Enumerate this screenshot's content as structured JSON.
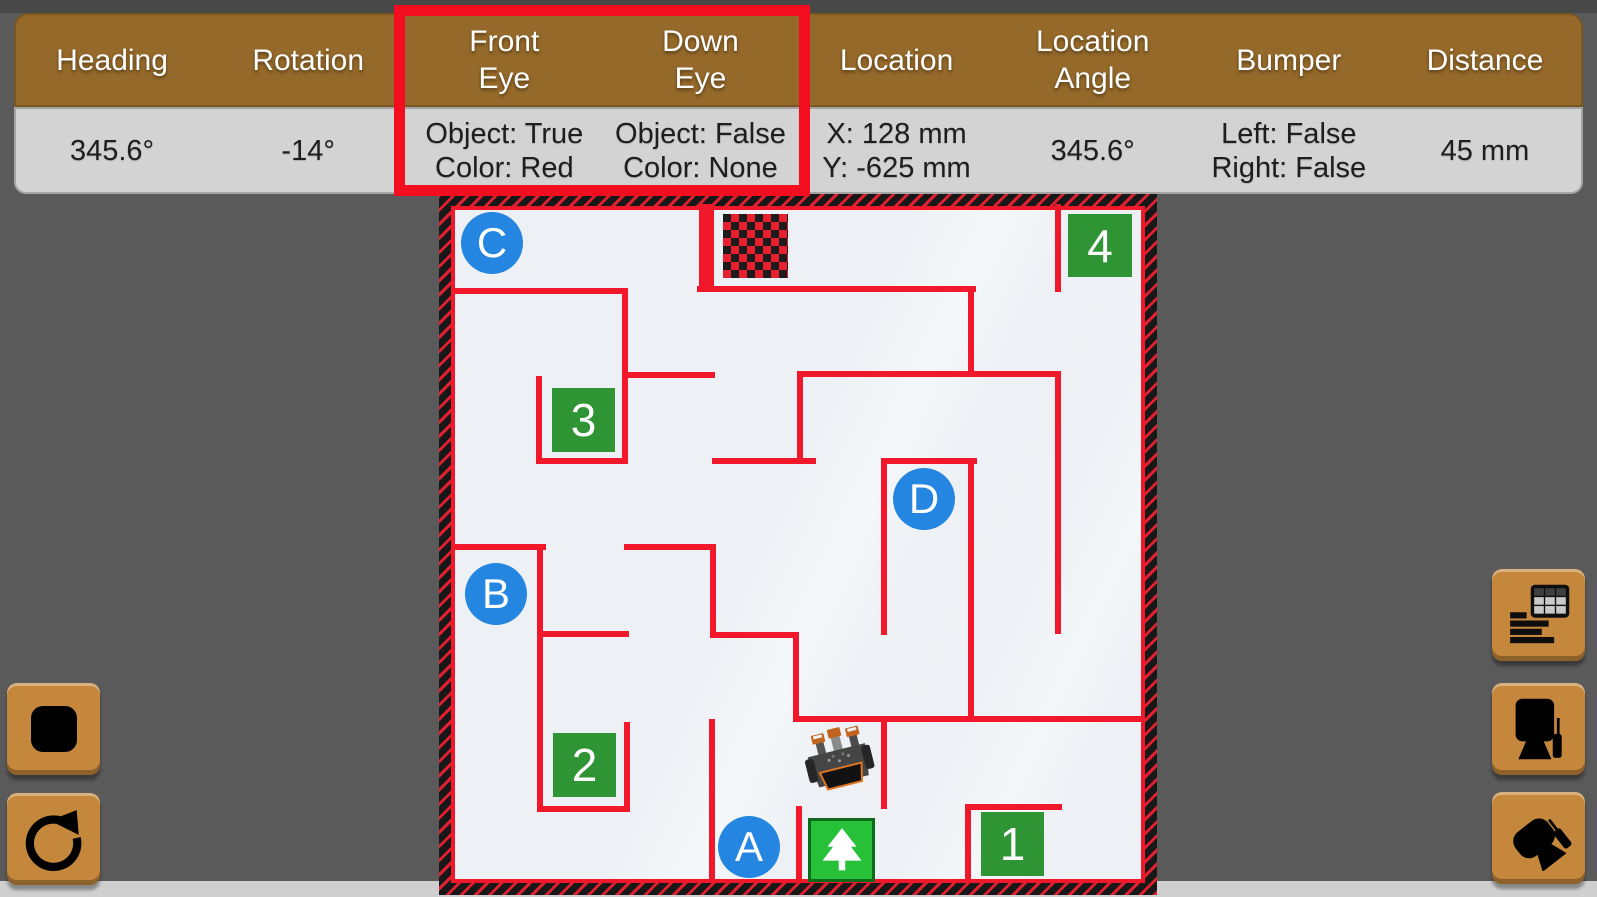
{
  "colors": {
    "page_bg": "#5a5a5a",
    "top_strip": "#484848",
    "bottom_strip": "#cfcfcf",
    "header_bg": "#956929",
    "value_bg": "#d3d3d3",
    "highlight": "#f20d1f",
    "wall": "#f0182a",
    "hazard_red": "#e02030",
    "hazard_black": "#181818",
    "marker_blue": "#2486e0",
    "zone_green": "#2e9434",
    "start_green": "#26c138",
    "check_red": "#e81f2d",
    "check_black": "#1c1c1c",
    "button_orange": "#c5873b"
  },
  "status_bar": {
    "columns": [
      {
        "id": "heading",
        "label_lines": [
          "Heading"
        ],
        "value_lines": [
          "345.6°"
        ]
      },
      {
        "id": "rotation",
        "label_lines": [
          "Rotation"
        ],
        "value_lines": [
          "-14°"
        ]
      },
      {
        "id": "front-eye",
        "label_lines": [
          "Front",
          "Eye"
        ],
        "value_lines": [
          "Object: True",
          "Color: Red"
        ],
        "highlighted": true
      },
      {
        "id": "down-eye",
        "label_lines": [
          "Down",
          "Eye"
        ],
        "value_lines": [
          "Object: False",
          "Color: None"
        ],
        "highlighted": true
      },
      {
        "id": "location",
        "label_lines": [
          "Location"
        ],
        "value_lines": [
          "X: 128 mm",
          "Y: -625 mm"
        ]
      },
      {
        "id": "location-angle",
        "label_lines": [
          "Location",
          "Angle"
        ],
        "value_lines": [
          "345.6°"
        ]
      },
      {
        "id": "bumper",
        "label_lines": [
          "Bumper"
        ],
        "value_lines": [
          "Left: False",
          "Right: False"
        ]
      },
      {
        "id": "distance",
        "label_lines": [
          "Distance"
        ],
        "value_lines": [
          "45 mm"
        ]
      }
    ]
  },
  "maze": {
    "walls": [
      [
        260,
        10,
        15,
        88
      ],
      [
        258,
        92,
        279,
        6
      ],
      [
        529,
        92,
        6,
        91
      ],
      [
        358,
        177,
        264,
        6
      ],
      [
        358,
        177,
        6,
        93
      ],
      [
        273,
        264,
        104,
        6
      ],
      [
        616,
        10,
        6,
        88
      ],
      [
        616,
        177,
        6,
        263
      ],
      [
        12,
        94,
        177,
        6
      ],
      [
        183,
        94,
        6,
        176
      ],
      [
        97,
        182,
        6,
        88
      ],
      [
        97,
        264,
        92,
        6
      ],
      [
        189,
        178,
        87,
        6
      ],
      [
        442,
        264,
        96,
        6
      ],
      [
        442,
        264,
        6,
        177
      ],
      [
        529,
        264,
        6,
        262
      ],
      [
        354,
        522,
        348,
        6
      ],
      [
        354,
        438,
        6,
        90
      ],
      [
        271,
        438,
        89,
        6
      ],
      [
        271,
        350,
        6,
        94
      ],
      [
        185,
        350,
        92,
        6
      ],
      [
        12,
        350,
        95,
        6
      ],
      [
        98,
        350,
        6,
        265
      ],
      [
        98,
        437,
        92,
        6
      ],
      [
        185,
        528,
        6,
        85
      ],
      [
        98,
        612,
        93,
        6
      ],
      [
        270,
        525,
        6,
        160
      ],
      [
        442,
        522,
        6,
        93
      ],
      [
        526,
        610,
        97,
        6
      ],
      [
        526,
        610,
        6,
        75
      ],
      [
        357,
        612,
        6,
        73
      ]
    ],
    "checkpoints": [
      {
        "label": "A",
        "x": 310,
        "y": 653
      },
      {
        "label": "B",
        "x": 57,
        "y": 400
      },
      {
        "label": "C",
        "x": 53,
        "y": 49
      },
      {
        "label": "D",
        "x": 485,
        "y": 305
      }
    ],
    "zones": [
      {
        "label": "1",
        "x": 542,
        "y": 618,
        "w": 63,
        "h": 64
      },
      {
        "label": "2",
        "x": 114,
        "y": 539,
        "w": 63,
        "h": 64
      },
      {
        "label": "3",
        "x": 113,
        "y": 194,
        "w": 63,
        "h": 64
      },
      {
        "label": "4",
        "x": 629,
        "y": 20,
        "w": 64,
        "h": 63
      }
    ],
    "checkerboard": {
      "x": 284,
      "y": 20,
      "w": 65,
      "h": 64
    },
    "start_marker": {
      "x": 369,
      "y": 624,
      "w": 67,
      "h": 64
    },
    "robot": {
      "x": 366,
      "y": 534,
      "w": 67,
      "h": 62,
      "rotation_deg": -14
    }
  },
  "buttons": {
    "stop": {
      "icon": "stop-square-icon"
    },
    "reset": {
      "icon": "rotate-ccw-icon"
    },
    "data": {
      "icon": "data-table-icon"
    },
    "board": {
      "icon": "board-marker-icon"
    },
    "camera": {
      "icon": "tilted-camera-icon"
    }
  }
}
